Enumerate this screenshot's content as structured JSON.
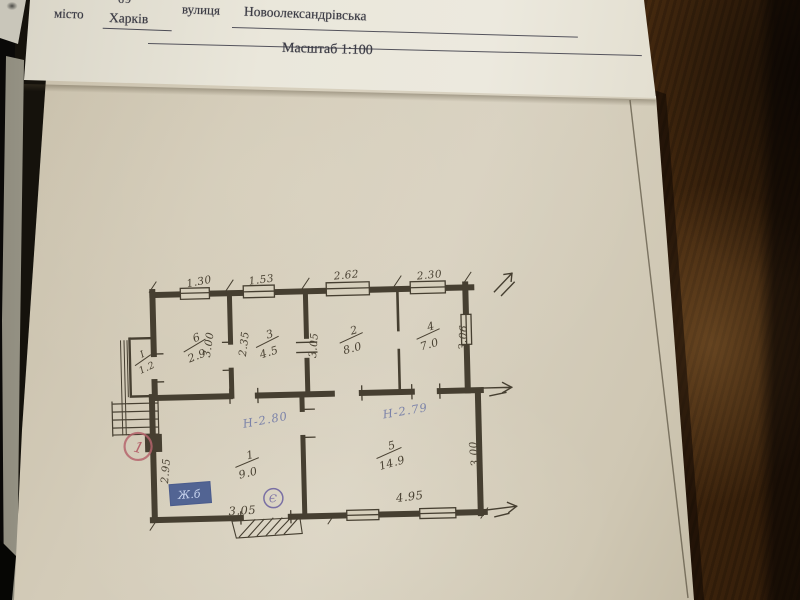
{
  "header": {
    "form_number": "69",
    "city_label": "місто",
    "city_value": "Харків",
    "street_label": "вулиця",
    "street_value": "Новоолександрівська",
    "scale_text": "Масштаб 1:100"
  },
  "plan": {
    "rooms": [
      {
        "number": "6",
        "area": "2.9"
      },
      {
        "number": "3",
        "area": "4.5"
      },
      {
        "number": "2",
        "area": "8.0"
      },
      {
        "number": "4",
        "area": "7.0"
      },
      {
        "number": "1",
        "area": "9.0"
      },
      {
        "number": "5",
        "area": "14.9"
      },
      {
        "number": "I",
        "area": "1.2"
      }
    ],
    "dims": {
      "top": [
        "1.30",
        "1.53",
        "2.62",
        "2.30"
      ],
      "vertical": [
        "3.00",
        "2.35",
        "3.05",
        "3.06",
        "2.95",
        "3.00"
      ],
      "bottom": [
        "3.05",
        "4.95"
      ]
    },
    "notes": {
      "height_room1": "Н-2.80",
      "height_room5": "Н-2.79",
      "stamp": "Ж.б",
      "circled_symbol": "Є",
      "red_circle_mark": "1"
    },
    "colors": {
      "ink": "#463f31",
      "blue_ink": "#7079a6",
      "red_ink": "#b5646c",
      "stamp_blue": "#44598f"
    }
  }
}
